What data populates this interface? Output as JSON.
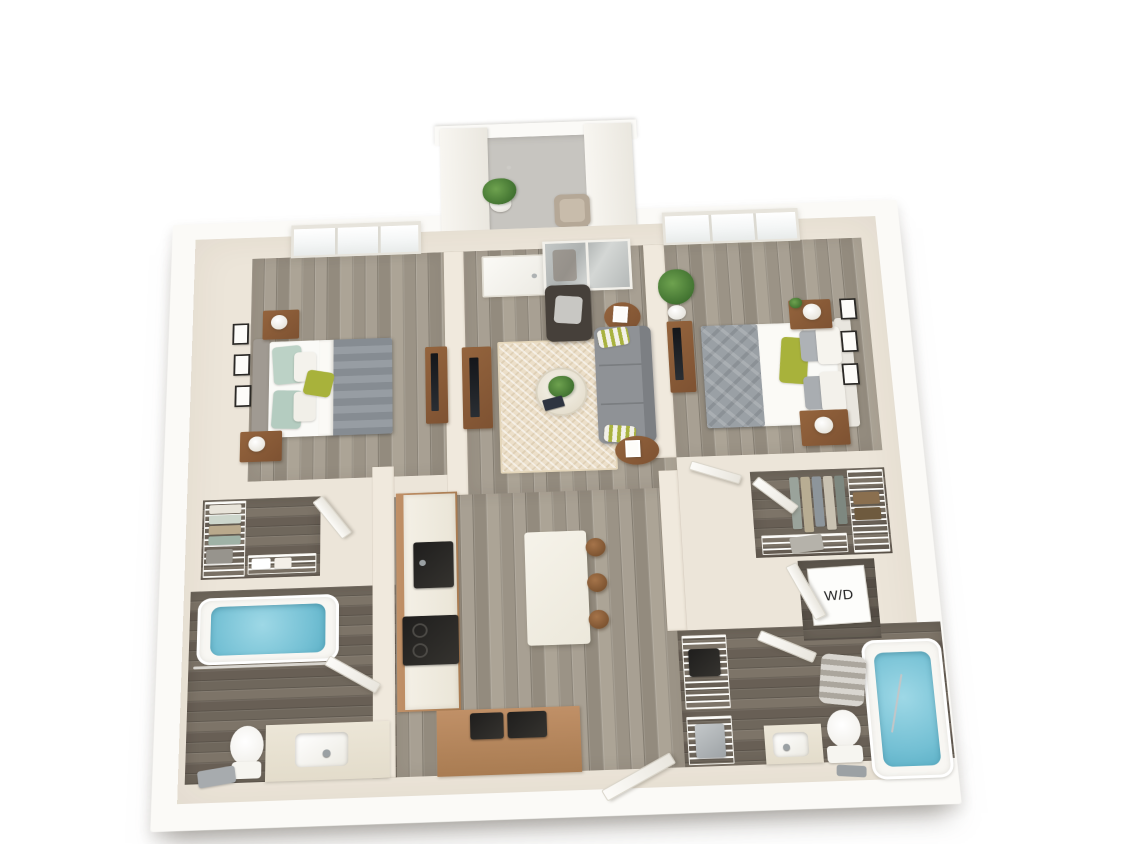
{
  "meta": {
    "title": "3D apartment floor plan render",
    "view": "two-bedroom two-bath unit, isometric top-down 3D",
    "background": "#ffffff"
  },
  "labels": {
    "washer_dryer": "W/D"
  },
  "palette": {
    "outer_wall": "#fbfaf7",
    "inner_wall": "#f0e9dd",
    "wood_floor_light": "#a29a8e",
    "wood_floor_dark": "#6f675c",
    "entry_concrete": "#c7c5c0",
    "rug_cream": "#ecdfc9",
    "sofa_gray": "#8f9296",
    "armchair_brown": "#46403a",
    "accent_green_pillow": "#a8b23b",
    "wood_furniture": "#94643d",
    "kitchen_cabinet": "#c09067",
    "tub_water_blue": "#74c0d4",
    "island_white": "#f6f3ea"
  },
  "rooms": [
    {
      "name": "entry-vestibule",
      "furniture": [
        "potted-plant",
        "accent-chair",
        "concrete-walkway",
        "pier-walls"
      ]
    },
    {
      "name": "bedroom-1",
      "furniture": [
        "queen-bed-gray-duvet",
        "green-accent-pillow",
        "two-nightstands",
        "two-lamps",
        "wall-frames-x3",
        "tv-console",
        "window"
      ]
    },
    {
      "name": "living-room",
      "furniture": [
        "gray-sofa",
        "dark-armchair",
        "round-side-tables-x2",
        "glass-coffee-table",
        "herringbone-rug",
        "tv-console",
        "entry-door",
        "mirror-closet"
      ]
    },
    {
      "name": "bedroom-2",
      "furniture": [
        "queen-bed-white-bedding",
        "gray-throw",
        "green-accent-pillow",
        "two-nightstands",
        "two-lamps",
        "wall-frames-x3",
        "tv-console",
        "tall-plant",
        "window"
      ]
    },
    {
      "name": "walk-in-closet-1",
      "furniture": [
        "wire-shelving",
        "hanging-clothes",
        "baskets",
        "door"
      ]
    },
    {
      "name": "bathroom-1",
      "furniture": [
        "bathtub",
        "shower-rod",
        "toilet",
        "vanity-sink",
        "bath-towel",
        "door"
      ]
    },
    {
      "name": "kitchen",
      "furniture": [
        "cabinet-run",
        "black-sink",
        "range-cooktop",
        "lower-counter-electronics",
        "island",
        "stools-x3"
      ]
    },
    {
      "name": "walk-in-closet-2",
      "furniture": [
        "wire-shelving",
        "hanging-clothes",
        "baskets",
        "door"
      ]
    },
    {
      "name": "laundry-closet",
      "furniture": [
        "washer-dryer-unit",
        "door"
      ]
    },
    {
      "name": "bathroom-2",
      "furniture": [
        "bathtub",
        "striped-shower-curtain",
        "toilet",
        "vanity-sink",
        "linen-shelves",
        "door"
      ]
    }
  ]
}
